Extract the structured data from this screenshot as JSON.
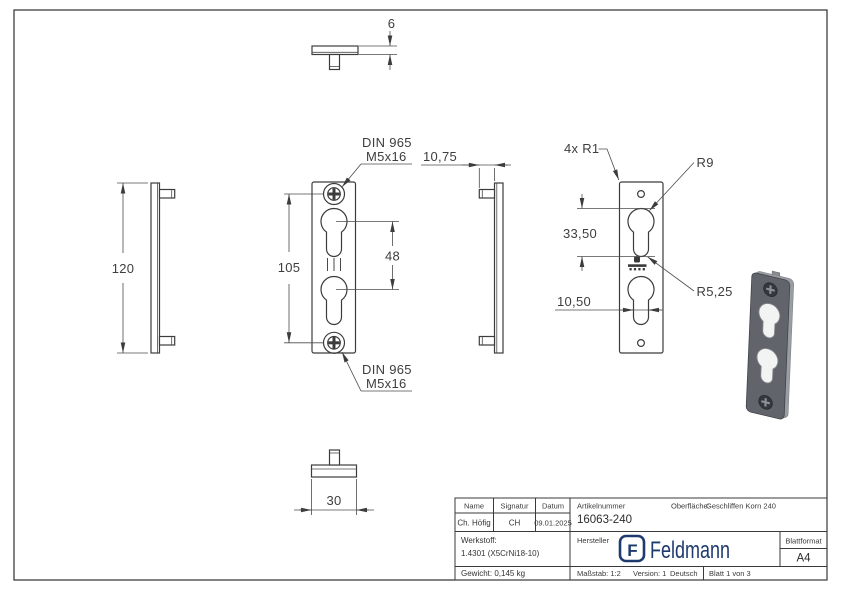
{
  "dimensions": {
    "plate_thickness": "6",
    "plate_height": "120",
    "screw_spacing": "105",
    "keyhole_pitch": "48",
    "boss_depth": "10,75",
    "plate_width": "30",
    "corner_radius": "4x R1",
    "keyhole_top_radius": "R9",
    "slot_length": "33,50",
    "slot_bottom_radius": "R5,25",
    "slot_width": "10,50"
  },
  "callouts": {
    "screw_top": {
      "line1": "DIN 965",
      "line2": "M5x16"
    },
    "screw_bottom": {
      "line1": "DIN 965",
      "line2": "M5x16"
    }
  },
  "title_block": {
    "name_label": "Name",
    "signature_label": "Signatur",
    "date_label": "Datum",
    "name": "Ch. Höfig",
    "signature": "CH",
    "date": "09.01.2025",
    "material_label": "Werkstoff:",
    "material": "1.4301 (X5CrNi18-10)",
    "weight": "Gewicht: 0,145 kg",
    "article_label": "Artikelnummer",
    "article_number": "16063-240",
    "surface_label": "Oberfläche:",
    "surface": "Geschliffen Korn 240",
    "manufacturer_label": "Hersteller",
    "brand_mark": "F",
    "brand": "Feldmann",
    "format_label": "Blattformat",
    "format": "A4",
    "scale": "Maßstab: 1:2",
    "version": "Version: 1",
    "language": "Deutsch",
    "sheet": "Blatt 1 von 3"
  },
  "colors": {
    "line": "#3c3c3c",
    "dimension": "#4b4b4b",
    "brand_navy": "#1e3a6e",
    "plate_face_3d": "#61656b",
    "plate_side_3d": "#999ea3",
    "keyhole_fill_3d": "#f2f3f3"
  }
}
